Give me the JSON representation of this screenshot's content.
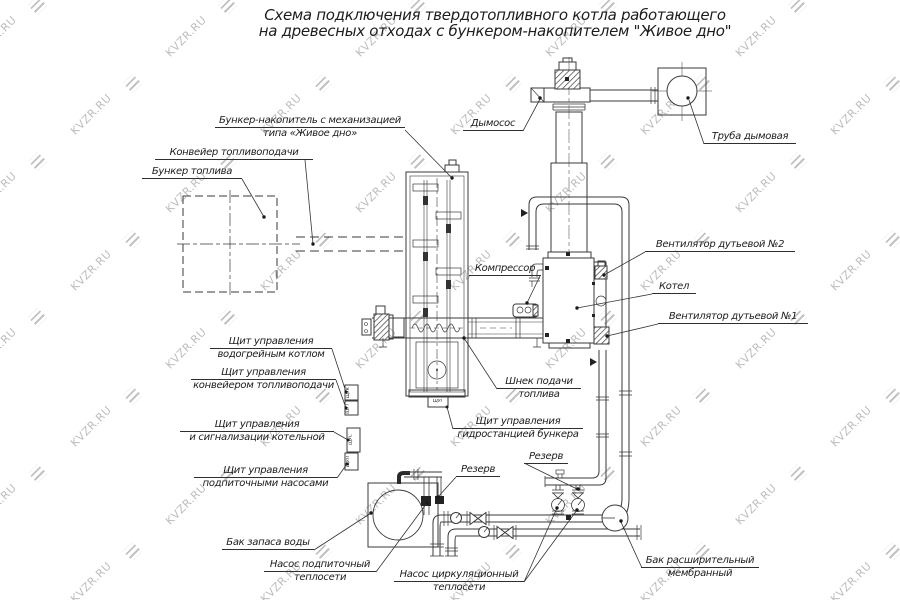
{
  "title": {
    "line1": "Схема подключения твердотопливного котла работающего",
    "line2": "на древесных отходах с бункером-накопителем \"Живое дно\""
  },
  "watermark": {
    "text": "KVZR.RU"
  },
  "labels": {
    "bunker_nakopitel": {
      "line1": "Бункер-накопитель с механизацией",
      "line2": "типа «Живое дно»"
    },
    "konveyer": {
      "text": "Конвейер топливоподачи"
    },
    "bunker_topliva": {
      "text": "Бункер топлива"
    },
    "dymosos": {
      "text": "Дымосос"
    },
    "truba_dymovaya": {
      "text": "Труба дымовая"
    },
    "ventilyator2": {
      "text": "Вентилятор дутьевой №2"
    },
    "kotel": {
      "text": "Котел"
    },
    "ventilyator1": {
      "text": "Вентилятор дутьевой №1"
    },
    "kompressor": {
      "text": "Компрессор"
    },
    "shnek": {
      "line1": "Шнек подачи",
      "line2": "топлива"
    },
    "schit_gidro": {
      "line1": "Щит управления",
      "line2": "гидростанцией бункера"
    },
    "schit_kotel": {
      "line1": "Щит управления",
      "line2": "водогрейным котлом"
    },
    "schit_konveyer": {
      "line1": "Щит управления",
      "line2": "конвейером топливоподачи"
    },
    "schit_signal": {
      "line1": "Щит управления",
      "line2": "и сигнализации котельной"
    },
    "schit_podpit": {
      "line1": "Щит управления",
      "line2": "подпиточными насосами"
    },
    "rezerv1": {
      "text": "Резерв"
    },
    "rezerv2": {
      "text": "Резерв"
    },
    "bak_zapasa": {
      "text": "Бак запаса воды"
    },
    "nasos_podpit": {
      "line1": "Насос подпиточный",
      "line2": "теплосети"
    },
    "nasos_cirk": {
      "line1": "Насос циркуляционный",
      "line2": "теплосети"
    },
    "bak_rasshir": {
      "line1": "Бак расширительный",
      "line2": "мембранный"
    }
  },
  "panels": {
    "p1": "ЩУК",
    "p2": "ЩУТ",
    "p3": "ЩУС",
    "p4": "ЩУП",
    "pg": "ЩУГ"
  },
  "colors": {
    "line": "#2e2e2e",
    "watermark": "#b2b2b2",
    "background": "#ffffff"
  }
}
